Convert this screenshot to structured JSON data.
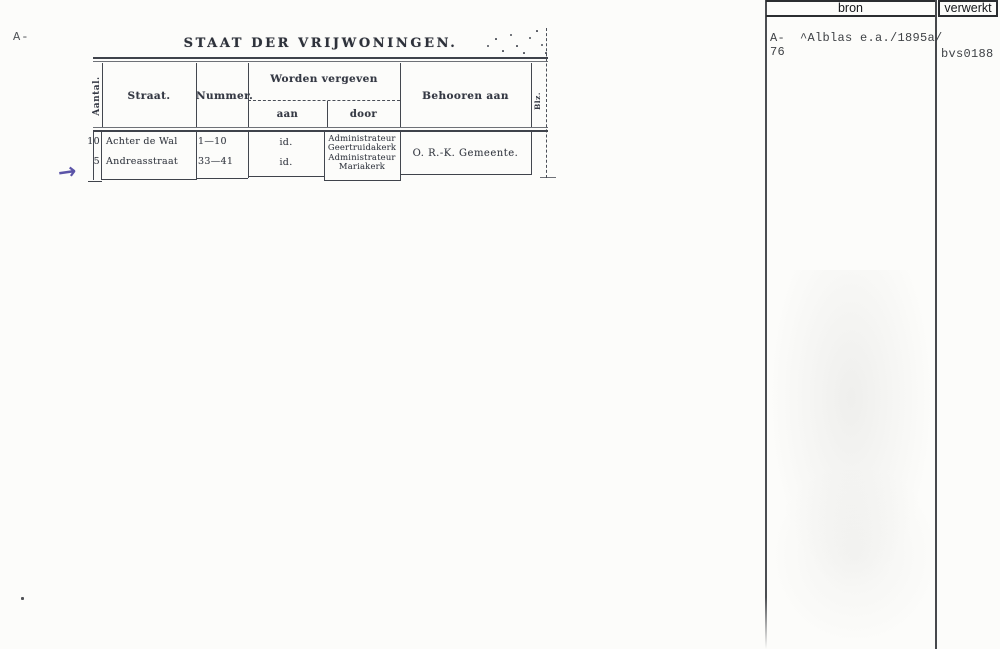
{
  "annotations": {
    "margin_code": "A-",
    "arrow_glyph": "→"
  },
  "document": {
    "title": "STAAT DER VRIJWONINGEN.",
    "headers": {
      "aantal": "Aantal.",
      "straat": "Straat.",
      "nummer": "Nummer.",
      "worden_vergeven": "Worden vergeven",
      "aan": "aan",
      "door": "door",
      "behooren_aan": "Behooren aan",
      "blz": "Blz."
    },
    "rows": [
      {
        "aantal": "10",
        "straat": "Achter de Wal",
        "nummer": "1—10",
        "aan": "id.",
        "door_line1": "Administrateur",
        "door_line2": "Geertruidakerk"
      },
      {
        "aantal": "5",
        "straat": "Andreasstraat",
        "nummer": "33—41",
        "aan": "id.",
        "door_line1": "Administrateur",
        "door_line2": "Mariakerk"
      }
    ],
    "behooren_value": "O. R.-K. Gemeente."
  },
  "index_panel": {
    "bron_header": "bron",
    "verwerkt_header": "verwerkt",
    "bron_line1": "A-  ^Alblas e.a./1895a/",
    "bron_line2": "76",
    "verwerkt_value": "bvs0188"
  },
  "colors": {
    "table_ink": "#3f434b",
    "typewriter_ink": "#3f4246",
    "annotation_purple": "#5b54a8",
    "paper": "#fcfcfa"
  }
}
